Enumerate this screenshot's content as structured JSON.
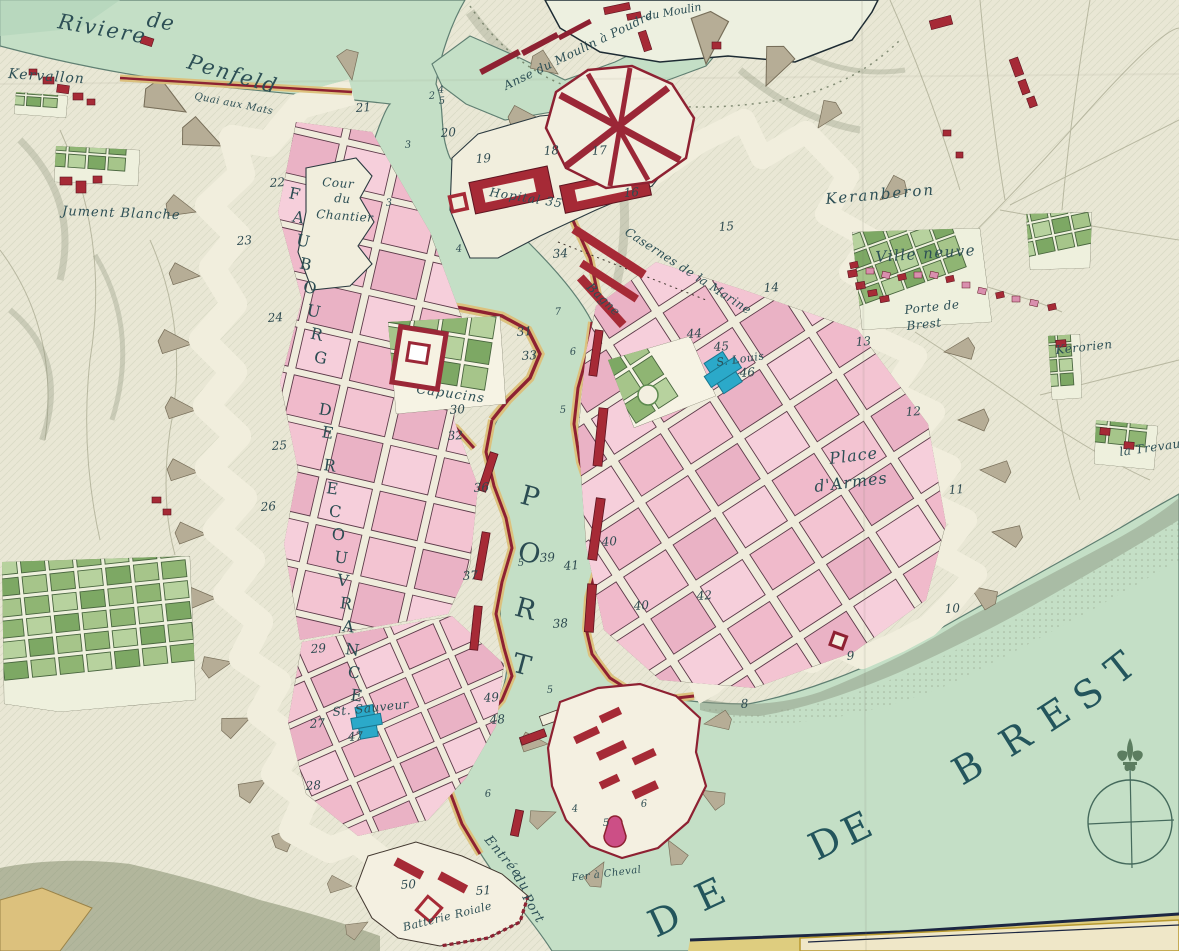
{
  "colors": {
    "paper": "#e9e7d5",
    "water": "#c4dfc6",
    "water_deep": "#b3d4ba",
    "shore_line": "#5f7f72",
    "city_pink": "#f3c4d2",
    "wall_crimson": "#8e2132",
    "rampart_tan": "#dcc17d",
    "glacis_grey": "#b6ad96",
    "garden_green": "#8fb573",
    "church_blue": "#2ba9c9",
    "label_ink": "#2d4f55",
    "border_navy": "#1c2742",
    "border_gold": "#decd7f"
  },
  "labels": [
    {
      "text": "Riviere",
      "x": 57,
      "y": 28,
      "size": 21,
      "rot": 10,
      "ls": 2
    },
    {
      "text": "de",
      "x": 146,
      "y": 26,
      "size": 21,
      "rot": 10,
      "ls": 1
    },
    {
      "text": "Penfeld",
      "x": 186,
      "y": 68,
      "size": 21,
      "rot": 16,
      "ls": 2
    },
    {
      "text": "Kervallon",
      "x": 8,
      "y": 78,
      "size": 14,
      "rot": 4,
      "ls": 1
    },
    {
      "text": "Quai aux Mats",
      "x": 194,
      "y": 99,
      "size": 10,
      "rot": 11,
      "ls": 0.5
    },
    {
      "text": "Jument Blanche",
      "x": 62,
      "y": 215,
      "size": 13,
      "rot": 2,
      "ls": 1
    },
    {
      "text": "Anse du Moulin à Poudre",
      "x": 506,
      "y": 90,
      "size": 12,
      "rot": -26,
      "ls": 0.5
    },
    {
      "text": "du Moulin",
      "x": 646,
      "y": 20,
      "size": 11,
      "rot": -10,
      "ls": 0
    },
    {
      "text": "Keranberon",
      "x": 826,
      "y": 204,
      "size": 15,
      "rot": -5,
      "ls": 2
    },
    {
      "text": "Ville neuve",
      "x": 876,
      "y": 262,
      "size": 15,
      "rot": -4,
      "ls": 1.5
    },
    {
      "text": "Porte de",
      "x": 905,
      "y": 314,
      "size": 12,
      "rot": -6,
      "ls": 0.5
    },
    {
      "text": "Brest",
      "x": 907,
      "y": 330,
      "size": 12,
      "rot": -6,
      "ls": 0.5
    },
    {
      "text": "Kerorien",
      "x": 1056,
      "y": 354,
      "size": 12,
      "rot": -6,
      "ls": 0.5
    },
    {
      "text": "la Trevau",
      "x": 1120,
      "y": 456,
      "size": 12,
      "rot": -8,
      "ls": 0.5
    },
    {
      "text": "Cour",
      "x": 322,
      "y": 186,
      "size": 12,
      "rot": 4,
      "ls": 0.5
    },
    {
      "text": "du",
      "x": 334,
      "y": 202,
      "size": 12,
      "rot": 4,
      "ls": 0.5
    },
    {
      "text": "Chantier",
      "x": 316,
      "y": 218,
      "size": 12,
      "rot": 4,
      "ls": 0.5
    },
    {
      "text": "Hopital 35",
      "x": 489,
      "y": 196,
      "size": 12,
      "rot": 9,
      "ls": 1
    },
    {
      "text": "Casernes de la Marine",
      "x": 624,
      "y": 234,
      "size": 12,
      "rot": 33,
      "ls": 0.5
    },
    {
      "text": "Bagne",
      "x": 586,
      "y": 288,
      "size": 12,
      "rot": 44,
      "ls": 0.5
    },
    {
      "text": "S. Louis",
      "x": 717,
      "y": 366,
      "size": 11,
      "rot": -8,
      "ls": 0.5
    },
    {
      "text": "Place",
      "x": 830,
      "y": 464,
      "size": 16,
      "rot": -7,
      "ls": 1
    },
    {
      "text": "d'Armes",
      "x": 815,
      "y": 492,
      "size": 16,
      "rot": -7,
      "ls": 1
    },
    {
      "text": "Capucins",
      "x": 416,
      "y": 393,
      "size": 13,
      "rot": 8,
      "ls": 1
    },
    {
      "text": "St. Sauveur",
      "x": 333,
      "y": 716,
      "size": 12,
      "rot": -6,
      "ls": 0.5
    },
    {
      "text": "Entrée",
      "x": 484,
      "y": 840,
      "size": 13,
      "rot": 50,
      "ls": 1
    },
    {
      "text": "du",
      "x": 513,
      "y": 877,
      "size": 13,
      "rot": 55,
      "ls": 1
    },
    {
      "text": "Port",
      "x": 522,
      "y": 897,
      "size": 13,
      "rot": 60,
      "ls": 1
    },
    {
      "text": "Fer à Cheval",
      "x": 572,
      "y": 881,
      "size": 10,
      "rot": -7,
      "ls": 0.5
    },
    {
      "text": "Batterie Roiale",
      "x": 404,
      "y": 931,
      "size": 11,
      "rot": -14,
      "ls": 0.5
    }
  ],
  "numbers": [
    {
      "t": "21",
      "x": 356,
      "y": 112
    },
    {
      "t": "20",
      "x": 441,
      "y": 137
    },
    {
      "t": "19",
      "x": 476,
      "y": 163
    },
    {
      "t": "18",
      "x": 544,
      "y": 155
    },
    {
      "t": "17",
      "x": 592,
      "y": 155
    },
    {
      "t": "16",
      "x": 624,
      "y": 197
    },
    {
      "t": "15",
      "x": 719,
      "y": 231
    },
    {
      "t": "14",
      "x": 764,
      "y": 292
    },
    {
      "t": "13",
      "x": 856,
      "y": 346
    },
    {
      "t": "12",
      "x": 906,
      "y": 416
    },
    {
      "t": "11",
      "x": 949,
      "y": 494
    },
    {
      "t": "10",
      "x": 945,
      "y": 613
    },
    {
      "t": "9",
      "x": 847,
      "y": 660
    },
    {
      "t": "8",
      "x": 741,
      "y": 708
    },
    {
      "t": "22",
      "x": 270,
      "y": 187
    },
    {
      "t": "23",
      "x": 237,
      "y": 245
    },
    {
      "t": "24",
      "x": 268,
      "y": 322
    },
    {
      "t": "25",
      "x": 272,
      "y": 450
    },
    {
      "t": "26",
      "x": 261,
      "y": 511
    },
    {
      "t": "29",
      "x": 311,
      "y": 653
    },
    {
      "t": "27",
      "x": 310,
      "y": 728
    },
    {
      "t": "28",
      "x": 306,
      "y": 790
    },
    {
      "t": "30",
      "x": 450,
      "y": 414
    },
    {
      "t": "31",
      "x": 517,
      "y": 336
    },
    {
      "t": "33",
      "x": 522,
      "y": 360
    },
    {
      "t": "32",
      "x": 448,
      "y": 440
    },
    {
      "t": "34",
      "x": 553,
      "y": 258
    },
    {
      "t": "36",
      "x": 474,
      "y": 492
    },
    {
      "t": "37",
      "x": 463,
      "y": 580
    },
    {
      "t": "38",
      "x": 553,
      "y": 628
    },
    {
      "t": "39",
      "x": 540,
      "y": 562
    },
    {
      "t": "41",
      "x": 564,
      "y": 570
    },
    {
      "t": "40",
      "x": 602,
      "y": 546
    },
    {
      "t": "40",
      "x": 634,
      "y": 610
    },
    {
      "t": "42",
      "x": 697,
      "y": 600
    },
    {
      "t": "44",
      "x": 687,
      "y": 338
    },
    {
      "t": "45",
      "x": 714,
      "y": 351
    },
    {
      "t": "46",
      "x": 740,
      "y": 377
    },
    {
      "t": "47",
      "x": 348,
      "y": 741
    },
    {
      "t": "49",
      "x": 484,
      "y": 702
    },
    {
      "t": "48",
      "x": 490,
      "y": 724
    },
    {
      "t": "50",
      "x": 401,
      "y": 889
    },
    {
      "t": "51",
      "x": 476,
      "y": 895
    }
  ],
  "depths": [
    {
      "t": "2",
      "x": 429,
      "y": 99
    },
    {
      "t": "4",
      "x": 438,
      "y": 93
    },
    {
      "t": "5",
      "x": 439,
      "y": 104
    },
    {
      "t": "3",
      "x": 405,
      "y": 148
    },
    {
      "t": "3",
      "x": 386,
      "y": 206
    },
    {
      "t": "4",
      "x": 456,
      "y": 252
    },
    {
      "t": "7",
      "x": 555,
      "y": 315
    },
    {
      "t": "6",
      "x": 570,
      "y": 355
    },
    {
      "t": "5",
      "x": 560,
      "y": 413
    },
    {
      "t": "5",
      "x": 518,
      "y": 566
    },
    {
      "t": "5",
      "x": 547,
      "y": 693
    },
    {
      "t": "6",
      "x": 485,
      "y": 797
    },
    {
      "t": "4",
      "x": 572,
      "y": 812
    },
    {
      "t": "5",
      "x": 603,
      "y": 826
    },
    {
      "t": "6",
      "x": 641,
      "y": 807
    }
  ],
  "sea_letters": [
    {
      "t": "D",
      "x": 656,
      "y": 938,
      "rot": -25
    },
    {
      "t": "E",
      "x": 703,
      "y": 912,
      "rot": -25
    },
    {
      "t": "D",
      "x": 817,
      "y": 861,
      "rot": -26
    },
    {
      "t": "E",
      "x": 850,
      "y": 846,
      "rot": -26
    },
    {
      "t": "B",
      "x": 962,
      "y": 786,
      "rot": -30
    },
    {
      "t": "R",
      "x": 1010,
      "y": 758,
      "rot": -32
    },
    {
      "t": "E",
      "x": 1050,
      "y": 733,
      "rot": -33
    },
    {
      "t": "S",
      "x": 1085,
      "y": 712,
      "rot": -35
    },
    {
      "t": "T",
      "x": 1118,
      "y": 686,
      "rot": -38
    }
  ],
  "vertical_words": [
    {
      "text": "FAUBOURG",
      "x": 288,
      "y": 198,
      "dx": 3.6,
      "dy": 23.4,
      "size": 16,
      "rot": 12
    },
    {
      "text": "DE",
      "x": 318,
      "y": 414,
      "dx": 3,
      "dy": 23,
      "size": 16,
      "rot": 10
    },
    {
      "text": "RECOUVRANCE",
      "x": 323,
      "y": 470,
      "dx": 2.7,
      "dy": 23,
      "size": 16,
      "rot": 8
    },
    {
      "text": "PORT",
      "x": 519,
      "y": 503,
      "dx": -2.8,
      "dy": 56,
      "size": 27,
      "rot": 15
    }
  ],
  "compass": {
    "cx": 1130,
    "cy": 822,
    "r": 42
  }
}
